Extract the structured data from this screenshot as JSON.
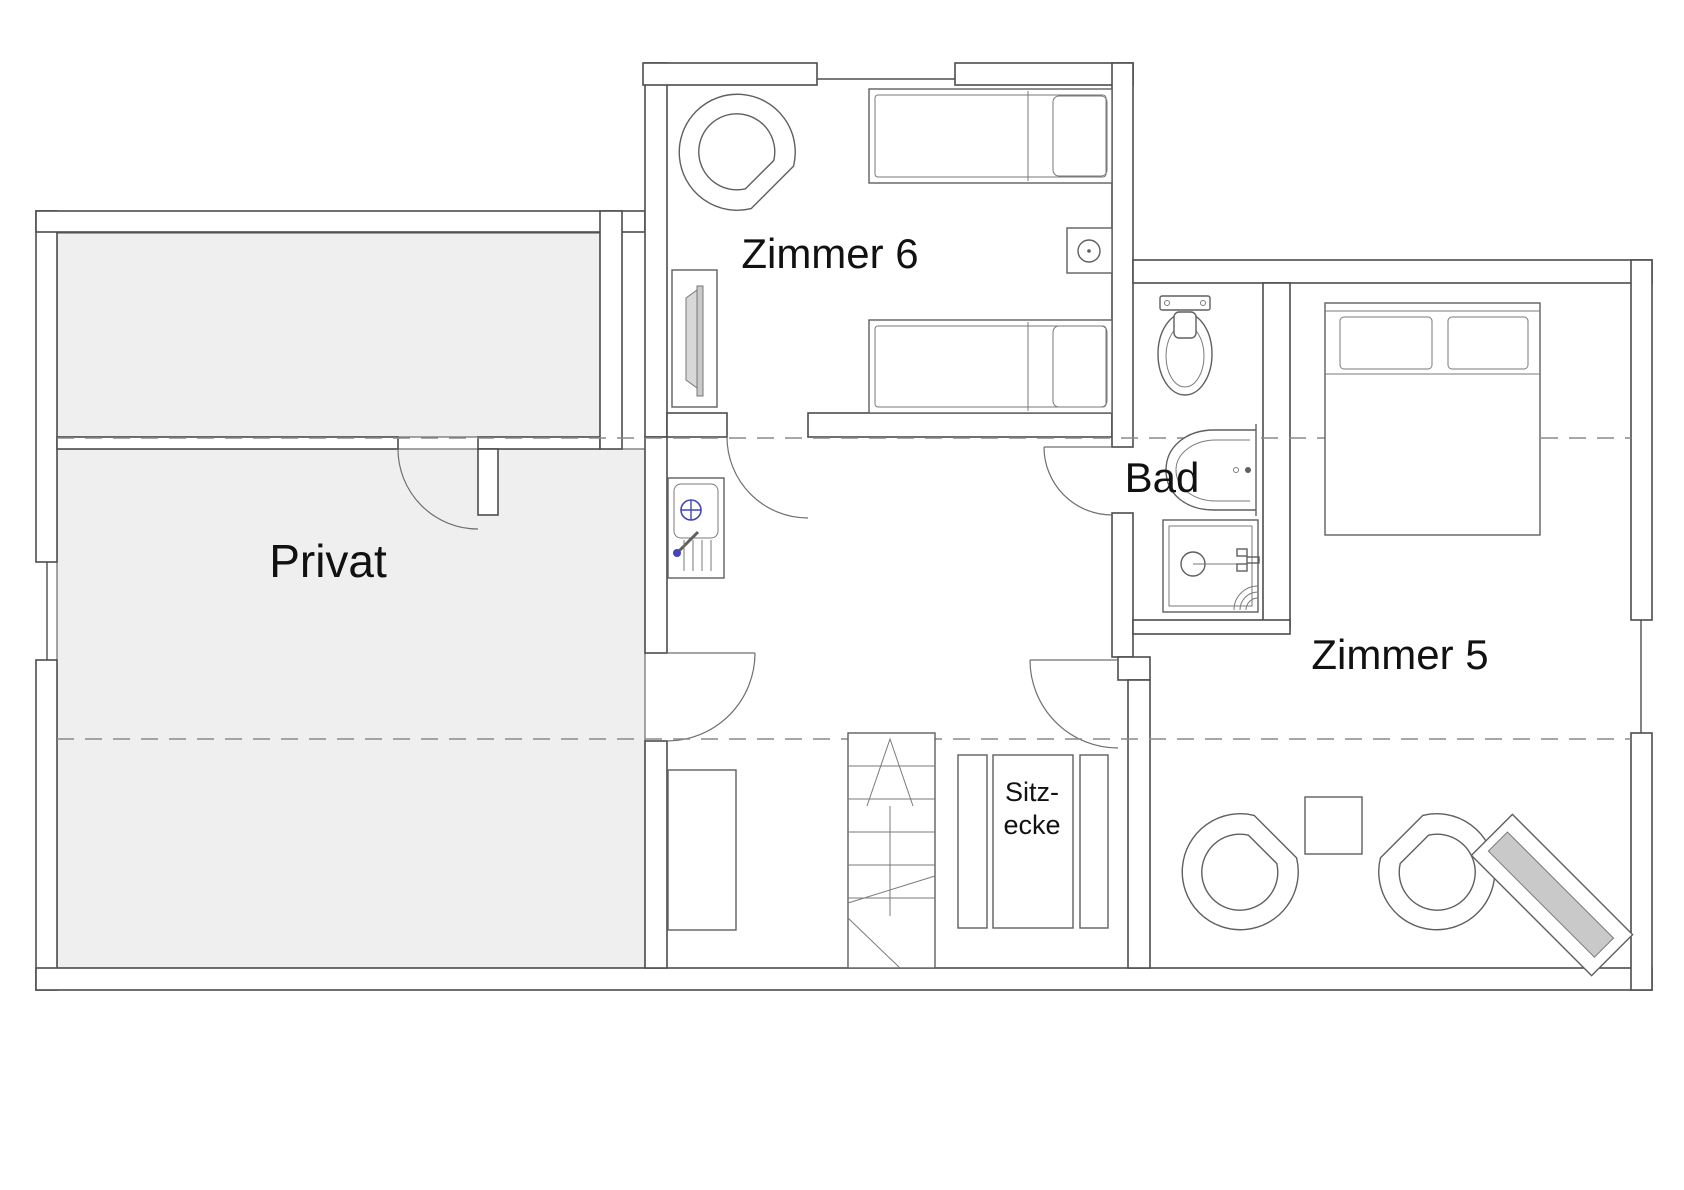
{
  "plan": {
    "title": "Obergeschoss Grundriss (floor plan)",
    "labels": {
      "room6": "Zimmer 6",
      "bath": "Bad",
      "private": "Privat",
      "room5": "Zimmer 5",
      "seating_line1": "Sitz-",
      "seating_line2": "ecke"
    },
    "colors": {
      "background": "#ffffff",
      "wall_line": "#4d4d4d",
      "furniture_line": "#5f5f5f",
      "room_fill": "#efefef",
      "panel_fill": "#c9c9c9",
      "accent_blue": "#4444bb",
      "text": "#111111",
      "dash_line": "#8a8a8a"
    },
    "rooms": [
      {
        "id": "zimmer6",
        "label": "Zimmer 6",
        "furniture": [
          "armchair",
          "wardrobe",
          "single-bed",
          "single-bed",
          "nightstand"
        ]
      },
      {
        "id": "bad",
        "label": "Bad",
        "furniture": [
          "toilet",
          "washbasin",
          "shower"
        ]
      },
      {
        "id": "privat",
        "label": "Privat",
        "furniture": []
      },
      {
        "id": "zimmer5",
        "label": "Zimmer 5",
        "furniture": [
          "double-bed",
          "armchair",
          "armchair",
          "side-table",
          "radiator"
        ]
      },
      {
        "id": "flur",
        "label": "Sitz-ecke",
        "furniture": [
          "kitchenette-sink",
          "sideboard",
          "staircase",
          "bench-seating"
        ]
      }
    ]
  }
}
